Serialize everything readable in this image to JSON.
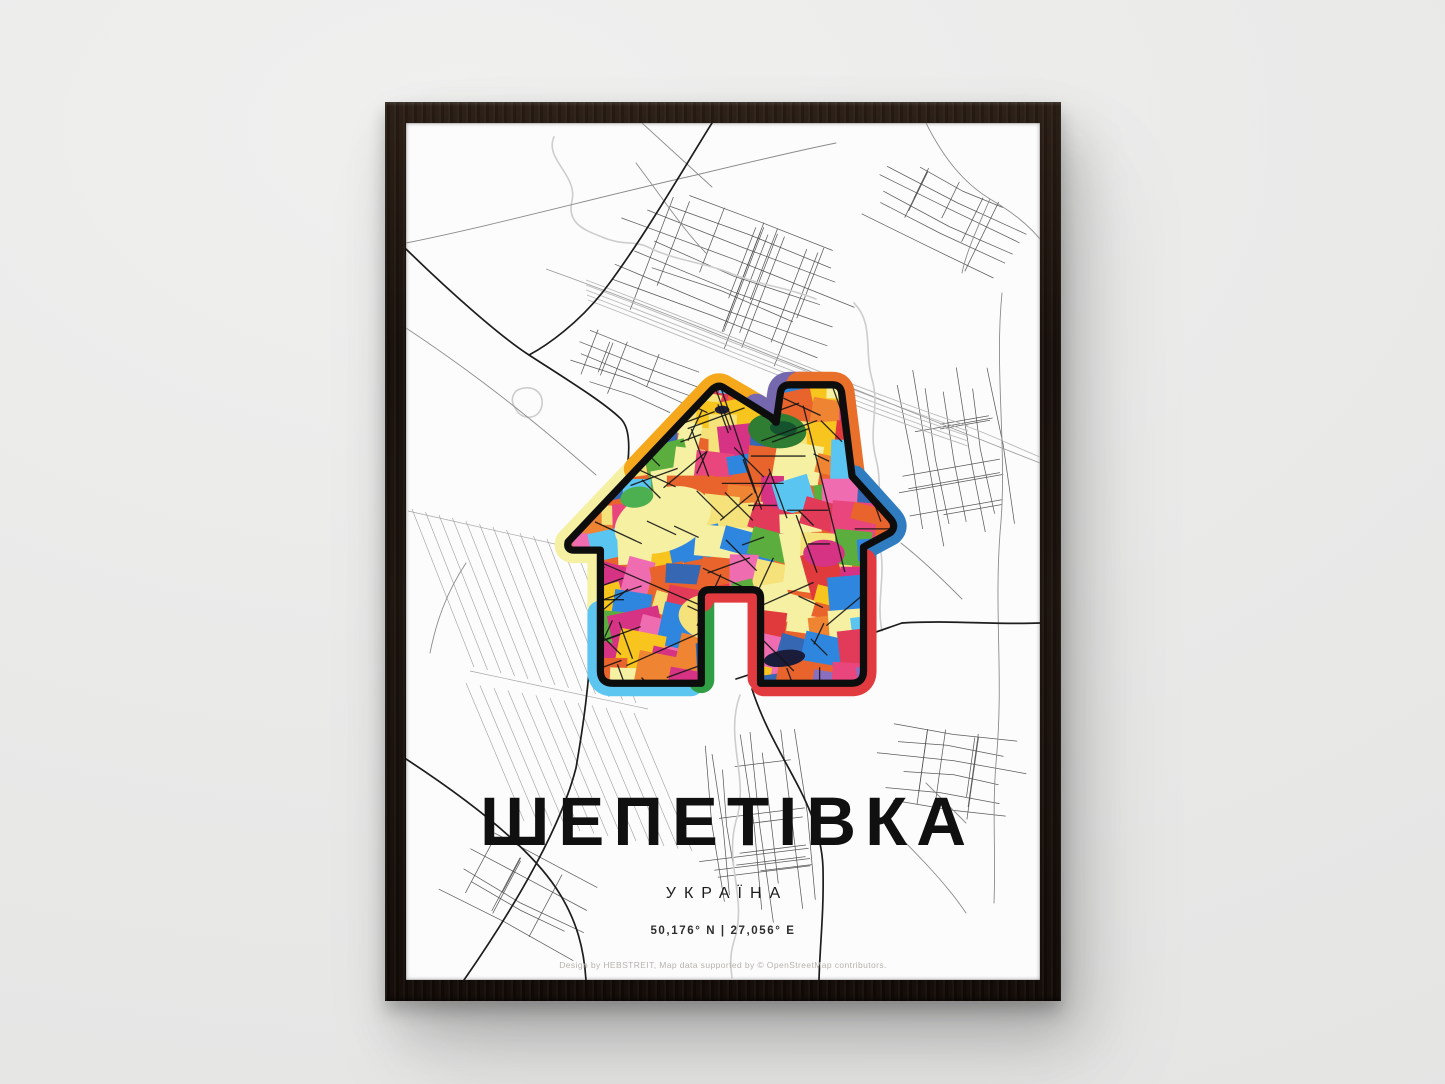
{
  "scene": {
    "wall_color": "#e9e9e8",
    "frame_color": "#170f0a",
    "paper_color": "#fcfcfc"
  },
  "poster": {
    "title": "ШЕПЕТІВКА",
    "country": "УКРАЇНА",
    "coordinates": "50,176° N | 27,056° E",
    "credit": "Design by HEBSTREIT, Map data supported by © OpenStreetMap contributors."
  },
  "map": {
    "road_dark": "#1d1d1d",
    "road_mid": "#8b8b8b",
    "road_light": "#cdcdcd",
    "railway": "#b8b8b8",
    "field_lines": "#a5a5a5",
    "street_cluster": "#4e4e4e"
  },
  "house": {
    "outline": "#0d0d0d",
    "street": "#151515",
    "pond": "#1b1b3a",
    "ring": {
      "light_blue": "#5cc6f1",
      "pale_yellow": "#f6f0a2",
      "amber": "#f6a81c",
      "purple": "#7568ae",
      "orange": "#e8702b",
      "blue": "#2f7cc0",
      "red": "#e23b3f",
      "green": "#2f9e44"
    },
    "mosaic_palette": [
      "#e8642c",
      "#e8642c",
      "#e03a3c",
      "#e23b5a",
      "#2e86de",
      "#2e86de",
      "#f7c51e",
      "#f06cb0",
      "#d63384",
      "#f6f0a2",
      "#f6f0a2",
      "#5bad3e",
      "#5bc5f2",
      "#8a6fc0",
      "#ef8432",
      "#f5e27a",
      "#e8467c",
      "#3567b2"
    ]
  }
}
